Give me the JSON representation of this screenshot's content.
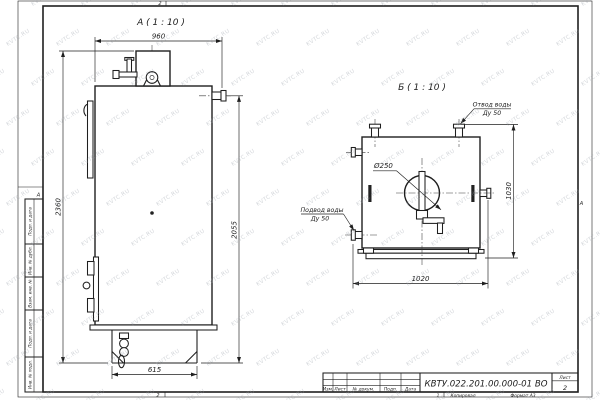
{
  "sheet": {
    "watermark_text": "KVTC.RU",
    "zone_top": "2",
    "zone_bottom": "2",
    "zone_left": "А",
    "zone_right": "А",
    "footer": {
      "sheet_copy": "1",
      "copied_label": "Копировал",
      "format_label": "Формат А3"
    },
    "side_columns": [
      "Подп. и дата",
      "Инв. № дубл.",
      "Взам. инв. №",
      "Подп. и дата",
      "Инв. № подл."
    ]
  },
  "title_block": {
    "doc_number": "КВТУ.022.201.00.000-01 ВО",
    "headers": [
      "Изм.",
      "Лист",
      "№ докум.",
      "Подп.",
      "Дата"
    ],
    "sheet_label": "Лист",
    "sheet_number": "2"
  },
  "view_a": {
    "title": "А ( 1 : 10 )",
    "dim_width": "960",
    "dim_height_total": "2360",
    "dim_height_body": "2055",
    "dim_base_width": "615"
  },
  "view_b": {
    "title": "Б ( 1 : 10 )",
    "dim_width": "1020",
    "dim_height": "1030",
    "dim_hatch": "Ø250",
    "outlet_label": [
      "Отвод воды",
      "Ду 50"
    ],
    "inlet_label": [
      "Подвод воды",
      "Ду 50"
    ]
  }
}
